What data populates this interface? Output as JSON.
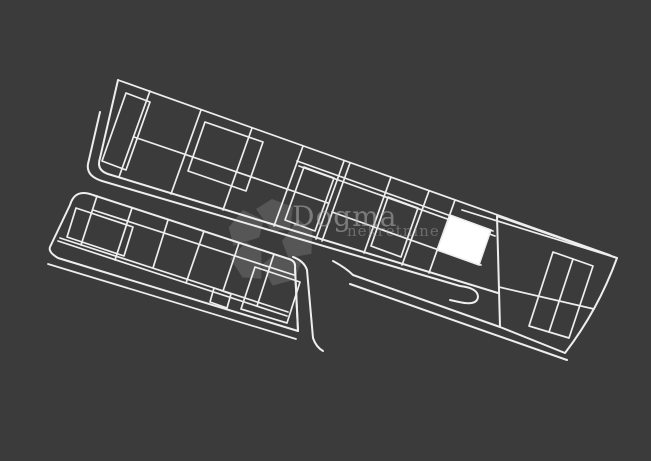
{
  "canvas": {
    "width": 651,
    "height": 461,
    "background": "#3b3b3b",
    "line_color": "#eeeeee",
    "highlight_color": "#ffffff"
  },
  "watermark": {
    "title": "Dogma",
    "subtitle": "nekretnine",
    "text_color": "#b0b0b0",
    "title_opacity": 0.55,
    "subtitle_opacity": 0.42,
    "logo": {
      "cx": 270,
      "cy": 243,
      "color": "#ffffff",
      "opacity": 0.14,
      "angles": [
        0,
        72,
        144,
        216,
        288
      ],
      "petal_path": "M 2,-12 L -14,-34 L 2,-44 L 23,-36 L 20,-13 Z"
    }
  },
  "plan": {
    "description": "site plan with two rows of land parcels, access roads and one highlighted parcel",
    "lines": [
      [
        118,
        80,
        610,
        255
      ],
      [
        462,
        210,
        617,
        258
      ],
      [
        150,
        91,
        119,
        177
      ],
      [
        201,
        110,
        171,
        194
      ],
      [
        252,
        128,
        223,
        210
      ],
      [
        303,
        146,
        274,
        226
      ],
      [
        344,
        161,
        316,
        239
      ],
      [
        350,
        163,
        322,
        241
      ],
      [
        391,
        177,
        364,
        253
      ],
      [
        429,
        191,
        402,
        265
      ],
      [
        455,
        200,
        429,
        273
      ],
      [
        134,
        137,
        328,
        203
      ],
      [
        297,
        161,
        493,
        231
      ],
      [
        299,
        166,
        495,
        236
      ],
      [
        332,
        212,
        481,
        265
      ],
      [
        499,
        287,
        594,
        309
      ],
      [
        573,
        259,
        549,
        332
      ],
      [
        93,
        210,
        294,
        275
      ],
      [
        60,
        238,
        288,
        312
      ],
      [
        58,
        241,
        287,
        316
      ],
      [
        48,
        264,
        296,
        339
      ],
      [
        97,
        196,
        81,
        245
      ],
      [
        132,
        208,
        115,
        260
      ],
      [
        168,
        220,
        153,
        268
      ],
      [
        204,
        231,
        186,
        283
      ],
      [
        239,
        243,
        223,
        291
      ],
      [
        274,
        254,
        257,
        306
      ]
    ],
    "paths": [
      "M118,80 L100,158 Q96,170 108,174 L498,293",
      "M100,112 L88,164 Q86,176 102,181 L460,286 Q478,288 478,297 Q477,306 459,302 L450,300",
      "M333,261 Q346,268 353,275 L500,327",
      "M350,284 L567,360",
      "M295,268 L298,331",
      "M293,257 Q304,261 307,270 L313,338 Q316,347 323,351",
      "M497,216 L617,258 Q598,310 565,353 L500,327 Z",
      "M93,195 L289,259 Q296,261 295,268 L298,331 L58,258 Q48,252 50,247 L70,205 Q75,188 93,195"
    ],
    "polygons": [
      [
        [
          553,
          252
        ],
        [
          593,
          266
        ],
        [
          569,
          338
        ],
        [
          529,
          326
        ]
      ],
      [
        [
          126,
          93
        ],
        [
          150,
          102
        ],
        [
          126,
          170
        ],
        [
          102,
          161
        ]
      ],
      [
        [
          205,
          122
        ],
        [
          263,
          142
        ],
        [
          246,
          191
        ],
        [
          188,
          171
        ]
      ],
      [
        [
          304,
          167
        ],
        [
          334,
          178
        ],
        [
          315,
          231
        ],
        [
          285,
          220
        ]
      ],
      [
        [
          388,
          197
        ],
        [
          418,
          208
        ],
        [
          401,
          257
        ],
        [
          371,
          246
        ]
      ],
      [
        [
          76,
          208
        ],
        [
          133,
          227
        ],
        [
          124,
          256
        ],
        [
          67,
          237
        ]
      ],
      [
        [
          214,
          288
        ],
        [
          231,
          294
        ],
        [
          227,
          308
        ],
        [
          210,
          302
        ]
      ],
      [
        [
          255,
          267
        ],
        [
          300,
          282
        ],
        [
          287,
          323
        ],
        [
          241,
          309
        ]
      ]
    ],
    "highlight": {
      "label": "highlighted parcel",
      "points": [
        [
          450,
          215
        ],
        [
          491,
          230
        ],
        [
          479,
          265
        ],
        [
          437,
          250
        ]
      ]
    }
  }
}
